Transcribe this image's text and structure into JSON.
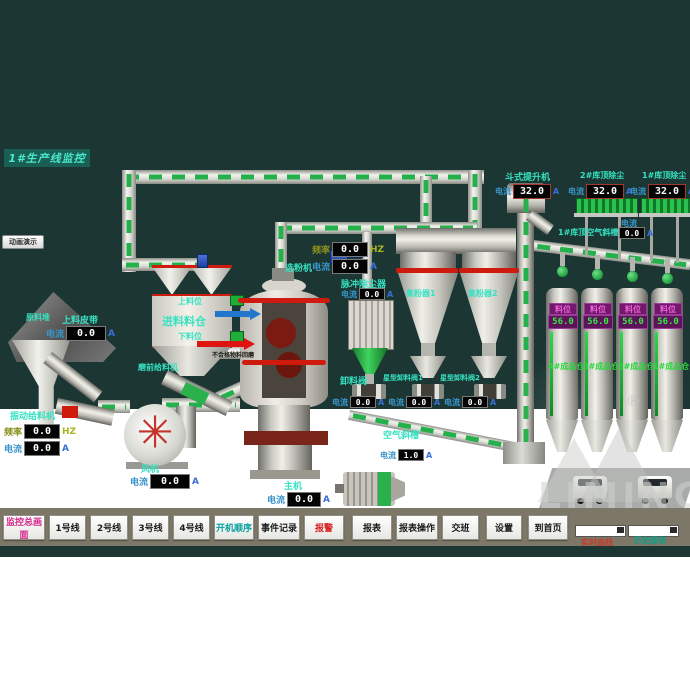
{
  "title": "1#生产线监控",
  "demo_button_label": "动画演示",
  "labels": {
    "current": "电流",
    "freq": "频率",
    "unit_a": "A",
    "unit_hz": "HZ"
  },
  "devices": {
    "material_pile": {
      "name": "原料堆"
    },
    "feed_belt": {
      "name": "上料皮带",
      "current": "0.0"
    },
    "vibrating_feeder": {
      "name": "振动给料机",
      "freq": "0.0",
      "current": "0.0"
    },
    "fan": {
      "name": "风机",
      "current": "0.0"
    },
    "feed_bin": {
      "name": "进料料仓",
      "upper_level": "上料位",
      "lower_level": "下料位"
    },
    "pre_mill_feeder": {
      "name": "磨前给料机"
    },
    "reject_return": {
      "name": "不合格物料回磨"
    },
    "classifier": {
      "name": "选粉机",
      "freq": "0.0",
      "current": "0.0"
    },
    "pulse_filter": {
      "name": "脉冲除尘器",
      "current": "0.0"
    },
    "discharge_valve": {
      "name": "卸料阀",
      "current": "0.0"
    },
    "cyclone_1": {
      "name": "集粉器1"
    },
    "cyclone_2": {
      "name": "集粉器2"
    },
    "star_valve_1": {
      "name": "星型卸料阀1",
      "current": "0.0"
    },
    "star_valve_2": {
      "name": "星型卸料阀2",
      "current": "0.0"
    },
    "air_chute": {
      "name": "空气斜槽",
      "current": "1.0"
    },
    "main_drive": {
      "name": "主机",
      "current": "0.0"
    },
    "bucket_elevator": {
      "name": "斗式提升机",
      "current": "32.0"
    },
    "silo2_top_dust": {
      "name": "2#库顶除尘",
      "current": "32.0"
    },
    "silo1_top_dust": {
      "name": "1#库顶除尘",
      "current": "32.0"
    },
    "silo_top_air_chute": {
      "name": "1#库顶空气斜槽",
      "current": "0.0"
    }
  },
  "silos": [
    {
      "name": "4#成品仓",
      "level_label": "料位",
      "level": "56.0"
    },
    {
      "name": "3#成品仓",
      "level_label": "料位",
      "level": "56.0"
    },
    {
      "name": "2#成品仓",
      "level_label": "料位",
      "level": "56.0"
    },
    {
      "name": "1#成品仓",
      "level_label": "料位",
      "level": "56.0"
    }
  ],
  "toolbar": {
    "buttons": [
      {
        "label": "监控总画面"
      },
      {
        "label": "1号线"
      },
      {
        "label": "2号线"
      },
      {
        "label": "3号线"
      },
      {
        "label": "4号线"
      },
      {
        "label": "开机顺序"
      },
      {
        "label": "事件记录"
      },
      {
        "label": "报警"
      },
      {
        "label": "报表"
      },
      {
        "label": "报表操作"
      },
      {
        "label": "交班"
      },
      {
        "label": "设置"
      },
      {
        "label": "到首页"
      }
    ],
    "realtime_curve_label": "实时曲线",
    "history_report_label": "历史报表"
  },
  "watermark": {
    "brand": "LIMING",
    "registered": "®"
  }
}
